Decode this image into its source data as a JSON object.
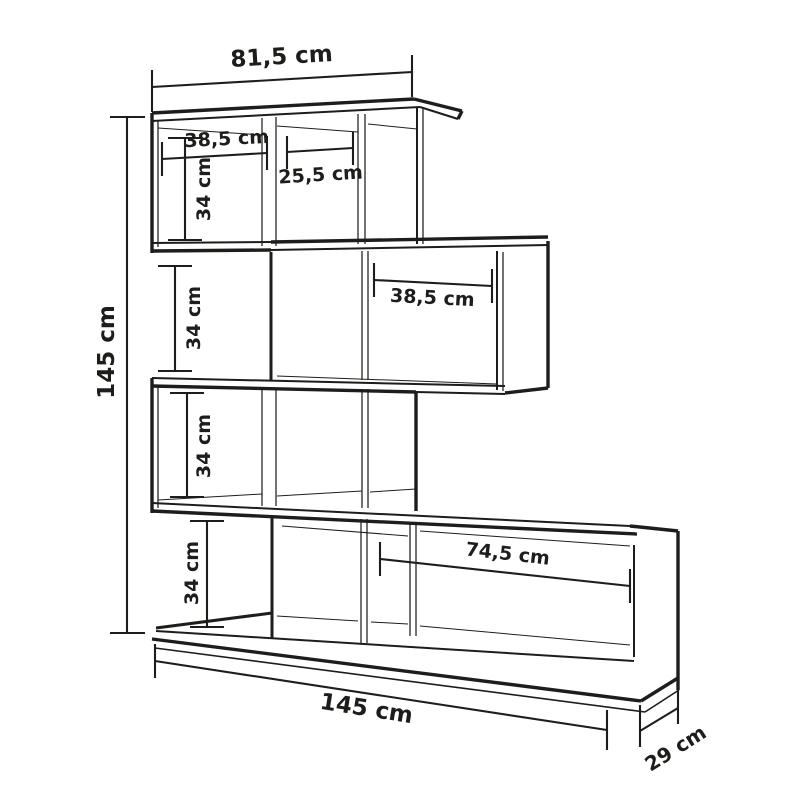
{
  "diagram": {
    "type": "furniture-dimension-drawing",
    "subject": "zigzag shelving unit with four staggered shelf rows",
    "unit": "cm",
    "line_color": "#1d1d1b",
    "background_color": "#ffffff",
    "dimensions": {
      "top_width": "81,5 cm",
      "total_height": "145 cm",
      "row1_left_compartment_width": "38,5 cm",
      "row1_middle_compartment_width": "25,5 cm",
      "row1_compartment_height": "34 cm",
      "gap_below_row1_height": "34 cm",
      "row2_compartment_width": "38,5 cm",
      "row3_compartment_height": "34 cm",
      "gap_above_base_height": "34 cm",
      "base_compartment_width": "74,5 cm",
      "total_width": "145 cm",
      "depth": "29 cm"
    }
  }
}
